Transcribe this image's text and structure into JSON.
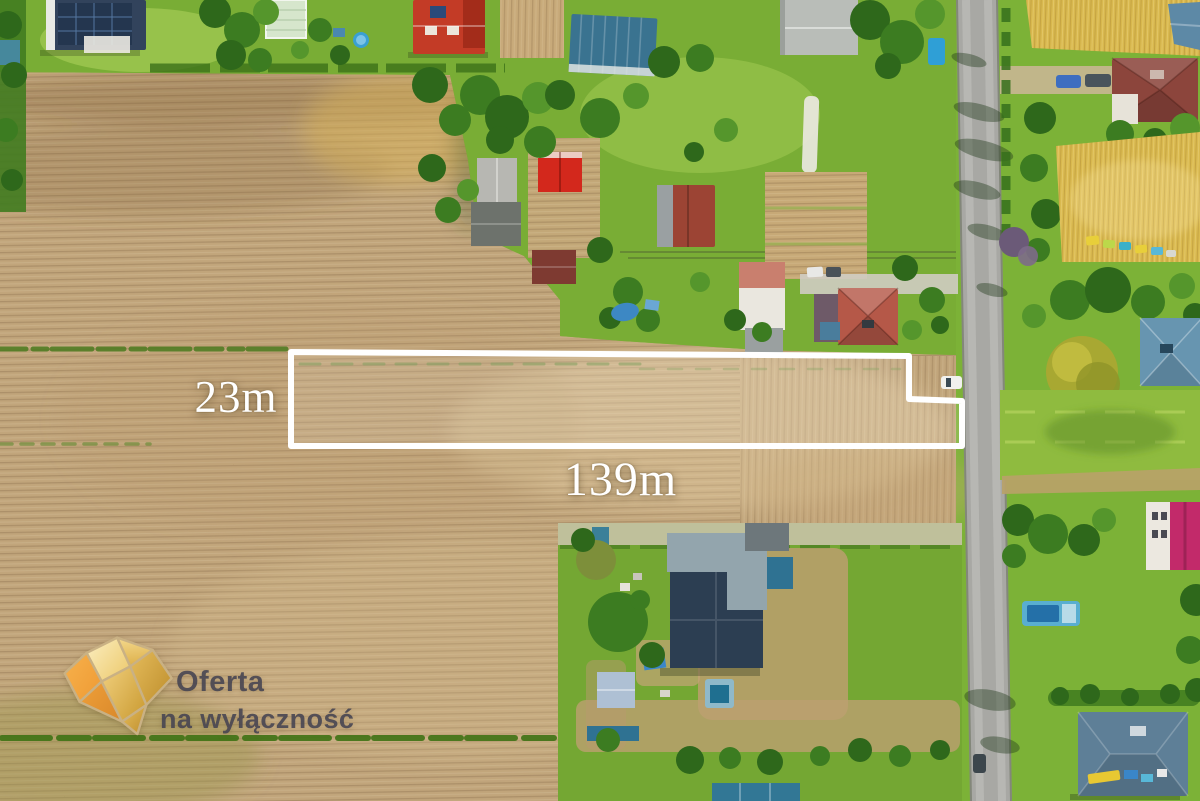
{
  "plot": {
    "depth_label": "23m",
    "width_label": "139m",
    "outline_color": "#ffffff"
  },
  "watermark": {
    "title": "Oferta",
    "subtitle": "na wyłączność",
    "text_color": "#484652",
    "diamond_gold": "#e3b042",
    "diamond_orange": "#f2a340"
  },
  "palette": {
    "plowed_field": "#c1a57b",
    "grass": "#7cb237",
    "road": "#a8a8a4",
    "wheat_field": "#d8b84e"
  }
}
